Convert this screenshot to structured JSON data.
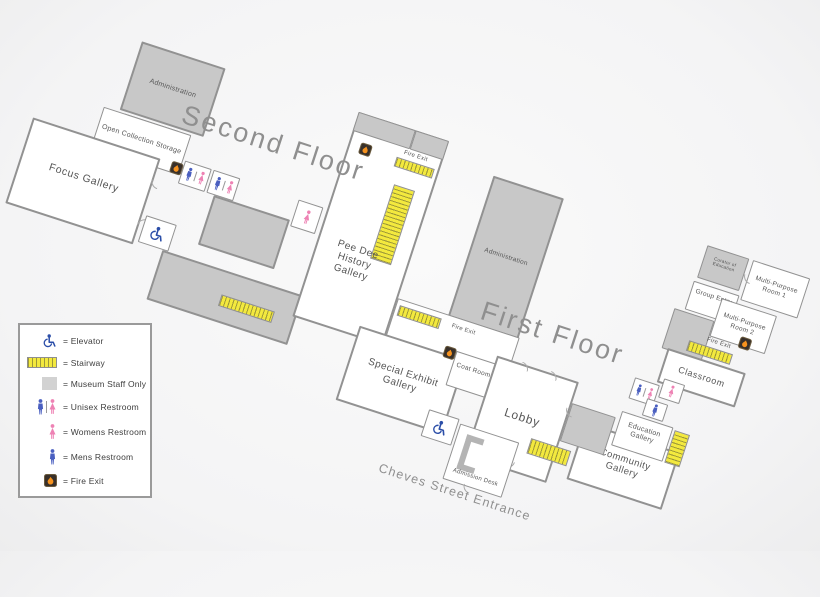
{
  "titles": {
    "second_floor": "Second Floor",
    "first_floor": "First Floor"
  },
  "second_floor": {
    "administration": "Administration",
    "open_collection_storage": "Open Collection Storage",
    "focus_gallery": "Focus Gallery",
    "pee_dee_history_gallery": "Pee Dee History Gallery",
    "fire_exit": "Fire Exit"
  },
  "first_floor": {
    "administration": "Administration",
    "fire_exit_west": "Fire Exit",
    "special_exhibit_gallery": "Special Exhibit Gallery",
    "coat_room": "Coat Room",
    "lobby": "Lobby",
    "admission_desk": "Admission Desk",
    "cheves_street_entrance": "Cheves Street Entrance",
    "curator_of_education": "Curator of Education",
    "group_entry": "Group Entry",
    "multi_purpose_room_1": "Multi-Purpose Room 1",
    "multi_purpose_room_2": "Multi-Purpose Room 2",
    "fire_exit_east": "Fire Exit",
    "classroom": "Classroom",
    "education_gallery": "Education Gallery",
    "community_gallery": "Community Gallery"
  },
  "legend": {
    "items": [
      {
        "icon": "elevator-icon",
        "label": "= Elevator"
      },
      {
        "icon": "stairway-icon",
        "label": "= Stairway"
      },
      {
        "icon": "museum-staff-only-icon",
        "label": "= Museum Staff Only"
      },
      {
        "icon": "unisex-restroom-icon",
        "label": "= Unisex Restroom"
      },
      {
        "icon": "womens-restroom-icon",
        "label": "= Womens Restroom"
      },
      {
        "icon": "mens-restroom-icon",
        "label": "= Mens Restroom"
      },
      {
        "icon": "fire-exit-icon",
        "label": "= Fire Exit"
      }
    ]
  },
  "colors": {
    "staff_area": "#c8c8c8",
    "stairway_yellow": "#f3e93e",
    "mens_blue": "#4a5fc0",
    "womens_pink": "#ee82b4",
    "fire_exit_orange": "#f6921e",
    "wall": "#8f8f8f"
  }
}
